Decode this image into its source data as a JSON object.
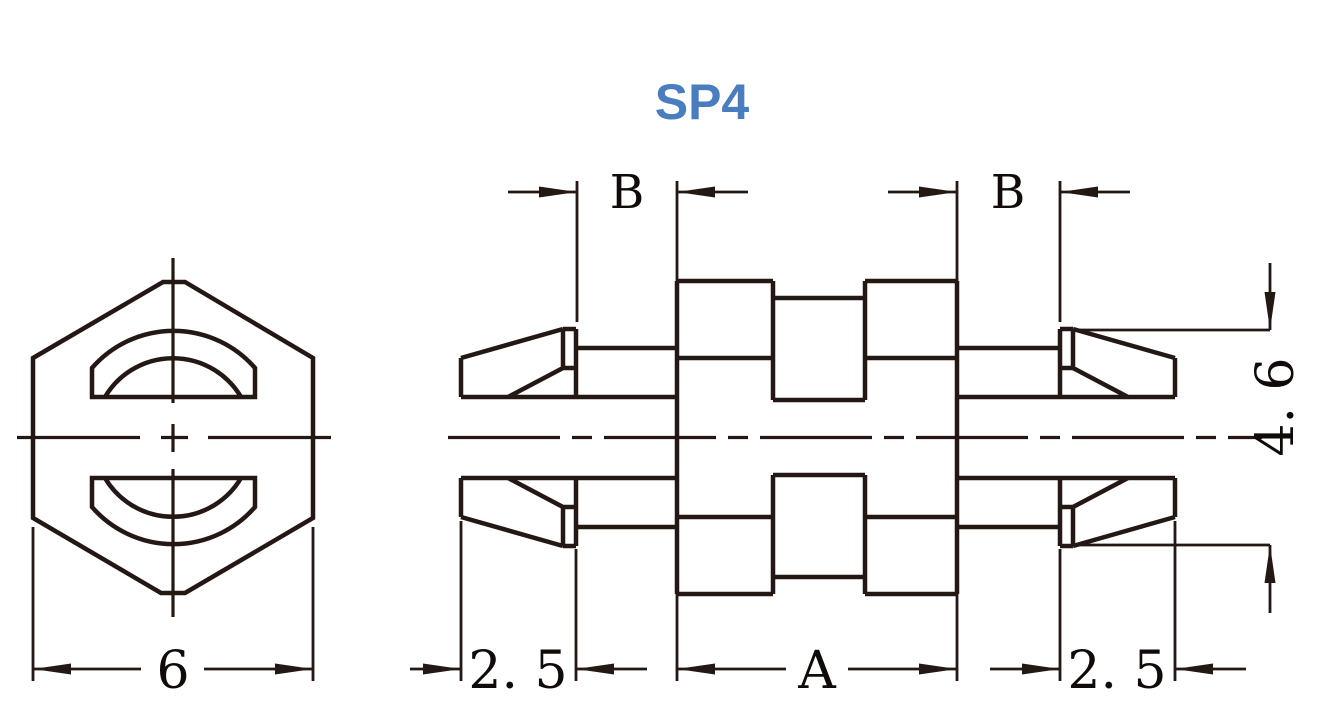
{
  "title": "SP4",
  "colors": {
    "title": "#4a7dbf",
    "line": "#241815",
    "background": "#ffffff"
  },
  "drawing": {
    "part_name": "SP4",
    "views": {
      "end_view": {
        "description": "hexagonal end view with two D-shaped prong holes",
        "labels": {
          "width_across_flats": "6"
        }
      },
      "side_view": {
        "description": "side view of double-ended snap spacer with barbed prongs",
        "labels": {
          "left_groove": "B",
          "right_groove": "B",
          "left_barb_length": "2. 5",
          "right_barb_length": "2. 5",
          "body_length": "A",
          "barb_height": "4. 6"
        }
      }
    }
  }
}
